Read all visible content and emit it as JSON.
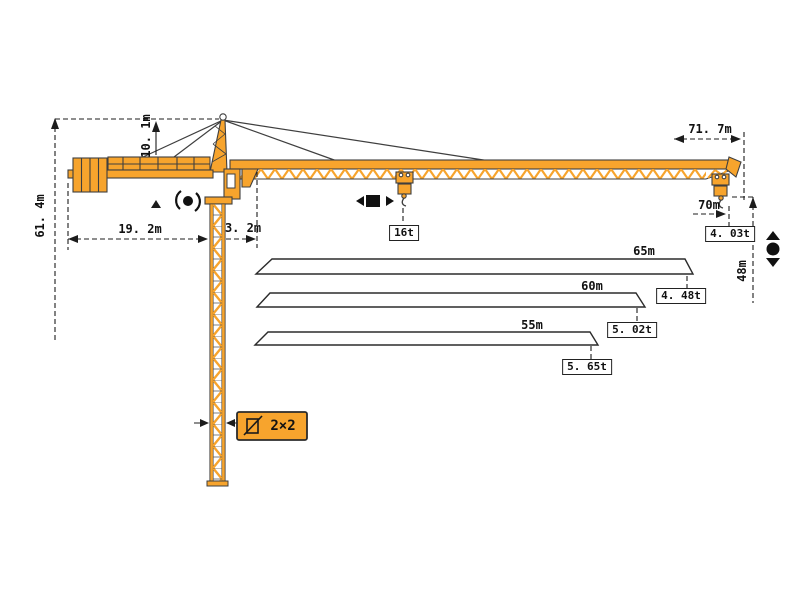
{
  "diagram": {
    "title": "tower crane dimensions and load chart",
    "colors": {
      "crane_orange": "#F7A42D",
      "outline": "#3F3F3F",
      "dimension_lines": "#1C1C1C",
      "background": "#FFFFFF"
    },
    "dimensions": {
      "total_height": "61. 4m",
      "tower_head_height": "10. 1m",
      "counter_jib_length": "19. 2m",
      "jib_pivot_offset": "3. 2m",
      "max_working_radius": "71. 7m",
      "jib_tip_radius": "70m",
      "hook_height": "48m",
      "mast_section": "2×2"
    },
    "loads": {
      "max_load": "16t",
      "tip_load": "4. 03t"
    },
    "jib_variants": [
      {
        "length": "65m",
        "tip_load": "4. 48t"
      },
      {
        "length": "60m",
        "tip_load": "5. 02t"
      },
      {
        "length": "55m",
        "tip_load": "5. 65t"
      }
    ],
    "icons": {
      "slewing": "rotation-icon",
      "trolley": "trolley-travel-icon",
      "hoisting": "hoist-up-down-icon",
      "section": "mast-cross-section-icon"
    }
  }
}
